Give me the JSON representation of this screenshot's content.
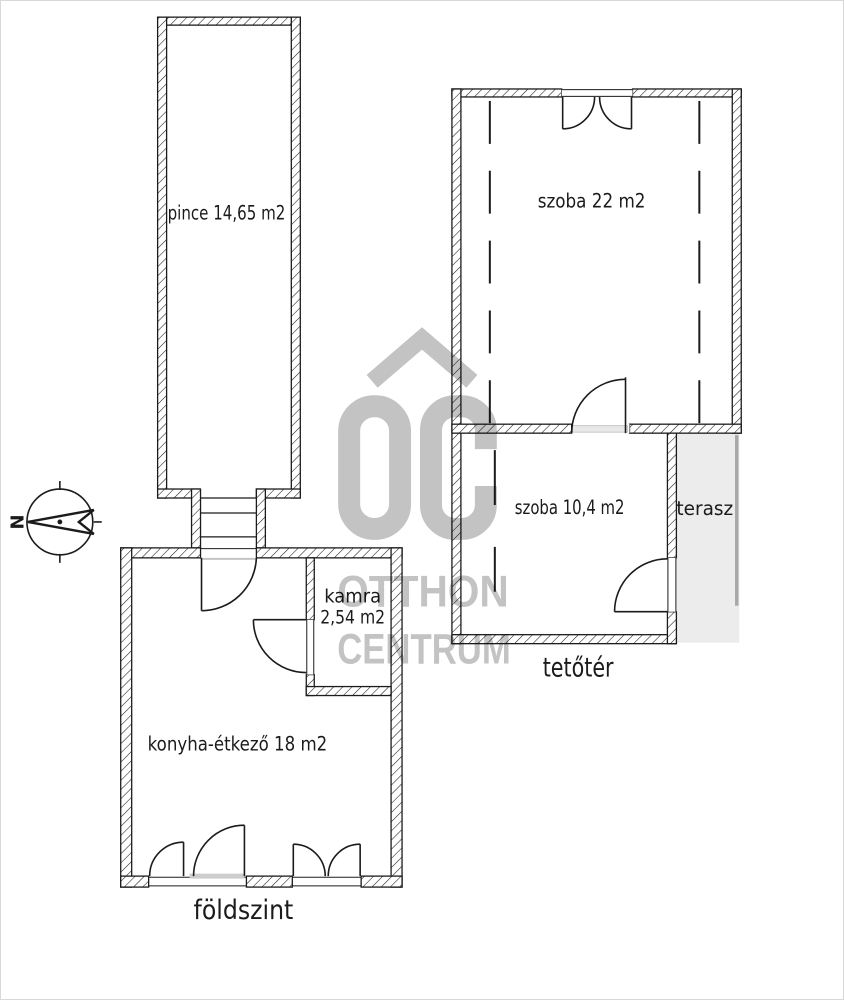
{
  "image": {
    "type": "real-estate floor plan"
  },
  "colors": {
    "line": "#1b1b1b",
    "background": "#ffffff",
    "watermark_gray": "#c3c3c3",
    "terrace_fill": "#ececec",
    "terrace_edge": "#a9a9a9",
    "threshold_gray": "#cdcdcd",
    "image_border": "#d8d8d8"
  },
  "labels": {
    "pince": "pince 14,65 m2",
    "szoba22": "szoba 22 m2",
    "szoba104": "szoba 10,4 m2",
    "terasz": "terasz",
    "kamra_line1": "kamra",
    "kamra_line2": "2,54 m2",
    "konyha": "konyha-étkező 18 m2",
    "foldszint": "földszint",
    "tetoter": "tetőtér"
  },
  "compass": {
    "north_letter": "N"
  },
  "watermark": {
    "monogram": "OC",
    "line1": "OTTHON",
    "line2": "CENTRUM"
  }
}
